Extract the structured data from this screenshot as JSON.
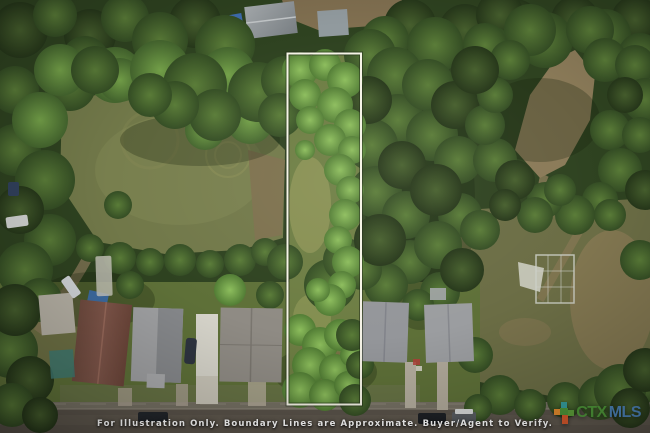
{
  "watermark": {
    "disclaimer": "For Illustration Only. Boundary Lines are Approximate. Buyer/Agent to Verify."
  },
  "logo": {
    "ctx": "CTX",
    "mls": "MLS",
    "colors": {
      "ctx_green": "#4f9a3a",
      "mls_blue": "#4e86c0",
      "icon_teal": "#35a2a5",
      "icon_orange": "#ef8f2f",
      "icon_red_orange": "#df5a2c",
      "icon_green": "#5fa33c"
    }
  },
  "boundary": {
    "outline_color": "#f5f3e6"
  }
}
